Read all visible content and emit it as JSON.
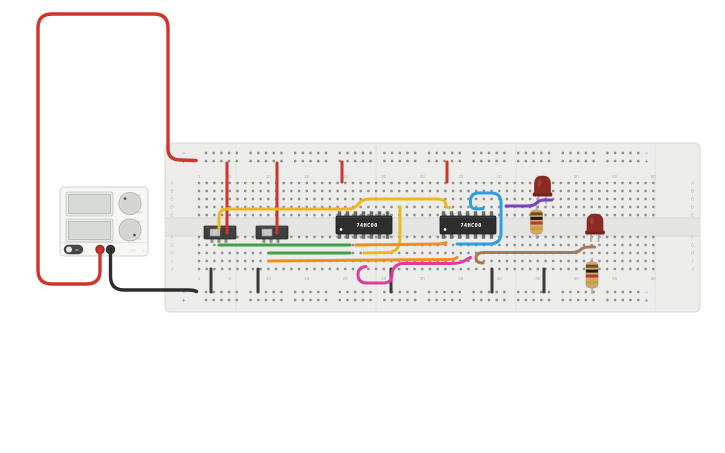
{
  "app": {
    "background": "#ffffff"
  },
  "power_supply": {
    "x": 60,
    "y": 187,
    "w": 88,
    "h": 69,
    "body_color": "#f6f6f4",
    "displays": [
      {
        "x": 66,
        "y": 192,
        "w": 47,
        "h": 24,
        "value": ""
      },
      {
        "x": 66,
        "y": 219,
        "w": 47,
        "h": 23,
        "value": ""
      }
    ],
    "knobs": [
      {
        "cx": 130,
        "cy": 203.5,
        "r": 11,
        "labels": [
          "0V",
          "30V"
        ],
        "ind_dx": -5,
        "ind_dy": -5
      },
      {
        "cx": 130,
        "cy": 230,
        "r": 11,
        "labels": [
          "DC",
          "5A"
        ],
        "ind_dx": 4.5,
        "ind_dy": 5
      }
    ],
    "power_toggle": {
      "x": 64,
      "y": 245,
      "w": 19,
      "h": 9,
      "label": "on"
    },
    "terminals": [
      {
        "cx": 100,
        "cy": 249.5,
        "color": "#c4342d",
        "ring": "#8e221d",
        "name": "positive-terminal"
      },
      {
        "cx": 110.5,
        "cy": 249.5,
        "color": "#3c3c3c",
        "ring": "#222222",
        "name": "negative-terminal"
      }
    ],
    "brand_dots": "000",
    "brand_bolt": "⌁"
  },
  "breadboard": {
    "x": 165,
    "y": 143,
    "w": 535,
    "h": 169,
    "board_color": "#ececea",
    "channel": {
      "y": 218,
      "h": 18
    },
    "seams_x": [
      236,
      376,
      516,
      655
    ],
    "row_labels_top": [
      "A",
      "B",
      "C",
      "D",
      "E"
    ],
    "row_labels_bottom": [
      "F",
      "G",
      "H",
      "I",
      "J"
    ],
    "rows_top_y": [
      183,
      191,
      199,
      207,
      215
    ],
    "rows_bottom_y": [
      237,
      245,
      253,
      261,
      269
    ],
    "col_first_x": 199,
    "col_pitch": 7.7,
    "num_cols": 60,
    "rail_rows_top_y": [
      153,
      161
    ],
    "rail_rows_bottom_y": [
      292,
      300
    ],
    "rail_group_start": 206,
    "rail_group_stride": 44.6,
    "rail_hole_pitch": 7.7,
    "rail_groups": 10,
    "plus": "+",
    "minus": "−",
    "plus_color": "#d4766c",
    "minus_color": "#7bafd4",
    "label_color": "#b2b2b0"
  },
  "ics": [
    {
      "label": "74HC00",
      "x": 336,
      "y": 216,
      "w": 56,
      "h": 18,
      "pins_per_side": 7
    },
    {
      "label": "74HC00",
      "x": 440,
      "y": 216,
      "w": 56,
      "h": 18,
      "pins_per_side": 7
    }
  ],
  "slide_switches": [
    {
      "x": 204,
      "y": 226,
      "w": 32,
      "h": 13
    },
    {
      "x": 256,
      "y": 226,
      "w": 32,
      "h": 13
    }
  ],
  "leds": [
    {
      "cx": 542.5,
      "top": 176,
      "legs_to": 204,
      "color": "#8c2a24",
      "flange": "#74231e",
      "highlight": "#a23f36"
    },
    {
      "cx": 595,
      "top": 214,
      "legs_to": 242,
      "color": "#8c2a24",
      "flange": "#74231e",
      "highlight": "#a23f36"
    }
  ],
  "resistors": [
    {
      "cx": 536.5,
      "lead_top": 205,
      "lead_bottom": 239,
      "body_y": 210,
      "body_h": 24,
      "bands": [
        "#7a4a12",
        "#1c1c1c",
        "#c0392b",
        "#c9a227"
      ]
    },
    {
      "cx": 592,
      "lead_top": 258,
      "lead_bottom": 294,
      "body_y": 262,
      "body_h": 26,
      "bands": [
        "#7a4a12",
        "#1c1c1c",
        "#c0392b",
        "#c9a227"
      ]
    }
  ],
  "wires": [
    {
      "name": "psu-positive-wire",
      "color": "#cf3529",
      "width": 3.4,
      "d": "M100 249 L100 271 Q100 284 86 284 L52 284 Q38 284 38 270 L38 28 Q38 14 52 14 L154 14 Q168 14 168 28 L168 149 Q168 160 181 160 L196 160.5"
    },
    {
      "name": "psu-negative-wire",
      "color": "#2e2e2e",
      "width": 3.4,
      "d": "M110.5 249 L110.5 276 Q110.5 290 124 290 L188 290 Q194 290 196.5 291.5"
    },
    {
      "name": "ground-jumper-1",
      "color": "#3a3a3a",
      "width": 3,
      "d": "M211 269 L211 292"
    },
    {
      "name": "ground-jumper-2",
      "color": "#3a3a3a",
      "width": 3,
      "d": "M258 269 L258 292"
    },
    {
      "name": "ground-jumper-3",
      "color": "#3a3a3a",
      "width": 3,
      "d": "M391 269 L391 292"
    },
    {
      "name": "ground-jumper-4",
      "color": "#3a3a3a",
      "width": 3,
      "d": "M492 269 L492 292"
    },
    {
      "name": "ground-jumper-5",
      "color": "#3a3a3a",
      "width": 3,
      "d": "M544 269 L544 292"
    },
    {
      "name": "power-jumper-switch1",
      "color": "#d0342c",
      "width": 3,
      "d": "M227 163 L227 233"
    },
    {
      "name": "power-jumper-switch2",
      "color": "#d0342c",
      "width": 3,
      "d": "M277 163 L277 233"
    },
    {
      "name": "power-jumper-ic1",
      "color": "#d0342c",
      "width": 3,
      "d": "M342 162 L342 182"
    },
    {
      "name": "power-jumper-ic2",
      "color": "#d0342c",
      "width": 3,
      "d": "M447 162 L447 182"
    },
    {
      "name": "yellow-wire-long",
      "color": "#efb71e",
      "width": 3,
      "d": "M219 229 L219 217 Q219 209 228 209 L347 209 Q355 209 358.5 204 Q362 199 370 199 L437 199 Q445 199 445.5 203.5 Q446 208 450 207.5"
    },
    {
      "name": "yellow-wire-short",
      "color": "#efb71e",
      "width": 3,
      "d": "M400 207 L400 239 Q400 250 390 252.5 L364 253"
    },
    {
      "name": "green-wire-top",
      "color": "#43a047",
      "width": 3,
      "d": "M219 245 L350 245"
    },
    {
      "name": "green-wire-bottom",
      "color": "#43a047",
      "width": 3,
      "d": "M269 253 L350 253"
    },
    {
      "name": "orange-wire-long",
      "color": "#ef8f1f",
      "width": 3,
      "d": "M269 261 L448 259.5 Q455 259.5 457 257.5"
    },
    {
      "name": "orange-wire-short",
      "color": "#ef8f1f",
      "width": 3,
      "d": "M356 245 L437 244 Q443 244 446 242.5"
    },
    {
      "name": "blue-wire",
      "color": "#2d9fe0",
      "width": 3,
      "d": "M457 244 L489 244 Q501 244 501 233 L501 203 Q501 193 491 193 L479 193 Q470.5 193 470.5 201 L470.5 203 Q470.5 209.5 478 209 L483 208.5"
    },
    {
      "name": "purple-wire",
      "color": "#7a43bd",
      "width": 3,
      "d": "M506 206 L527 206 Q534 206 536.5 203 Q539 200 545 200 L551.5 200"
    },
    {
      "name": "pink-wire",
      "color": "#e23a9d",
      "width": 3,
      "d": "M366 266.5 Q358 267.5 358 274.5 Q358 283 367 283 L383 283 Q392 283 392 275 Q392 265.5 402 263.5 L452 263.5 Q460 263.5 465 260.5 L470.5 257.5"
    },
    {
      "name": "brown-wire",
      "color": "#a97a52",
      "width": 3,
      "d": "M483 263 Q476 263 476 258 Q476 252.5 484 252.5 L571 252.5 Q578 252.5 580.5 249.8 Q583 247 589 247 L594.5 247"
    }
  ]
}
